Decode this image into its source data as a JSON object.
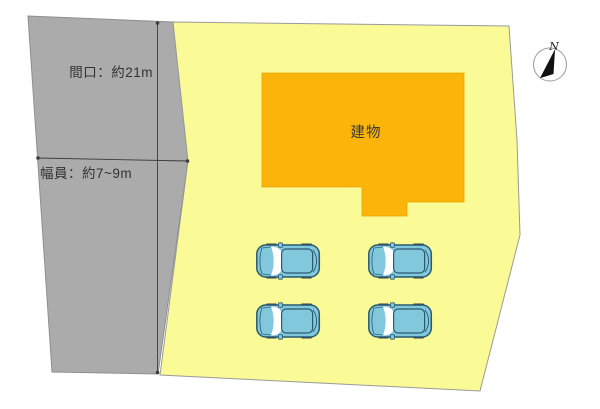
{
  "plan": {
    "labels": {
      "frontage": "間口：約21m",
      "road_width": "幅員：約7~9m",
      "building": "建物",
      "compass_north": "N"
    },
    "cars": {
      "count": 4
    },
    "colors": {
      "road": "#ABABAB",
      "road_border": "#8F8F8F",
      "lot": "#FAFA96",
      "lot_border": "#9A9A9A",
      "building": "#FBB40A",
      "building_border": "#E9A400",
      "car_body": "#82C8DC",
      "car_outline": "#2A5A70",
      "car_glass": "#FFFFFF",
      "car_wheel": "#3E3E3E",
      "dimension_line": "#3C3C3C",
      "compass_needle": "#111111",
      "compass_ring": "#999999"
    }
  }
}
